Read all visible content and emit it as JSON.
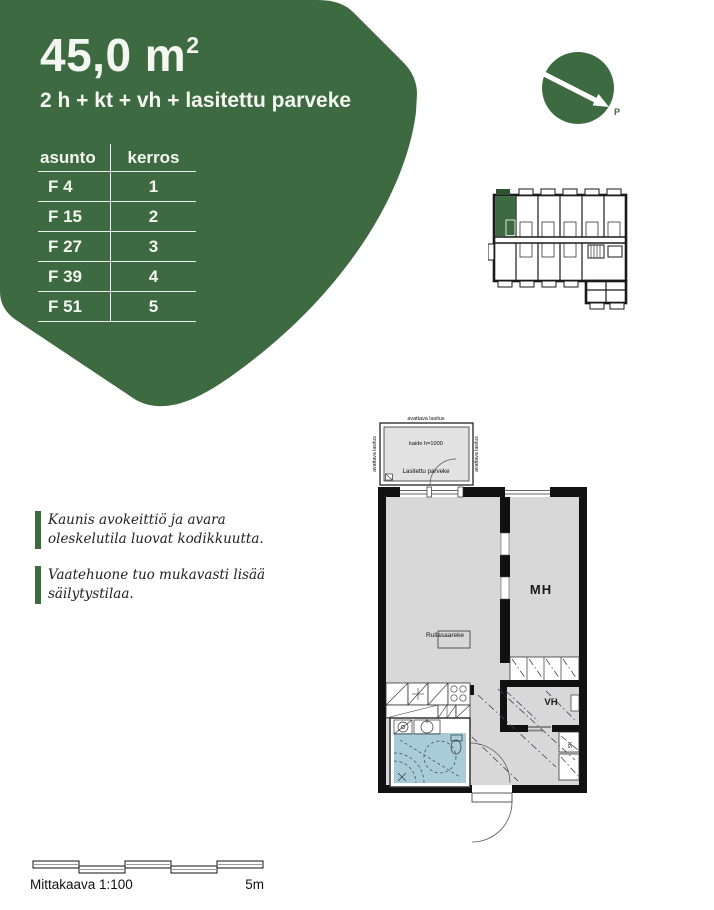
{
  "header": {
    "area_value": "45,0 m",
    "area_exponent": "2",
    "layout_description": "2 h + kt + vh + lasitettu parveke"
  },
  "apartment_table": {
    "col1": "asunto",
    "col2": "kerros",
    "rows": [
      {
        "asunto": "F 4",
        "kerros": "1"
      },
      {
        "asunto": "F 15",
        "kerros": "2"
      },
      {
        "asunto": "F 27",
        "kerros": "3"
      },
      {
        "asunto": "F 39",
        "kerros": "4"
      },
      {
        "asunto": "F 51",
        "kerros": "5"
      }
    ]
  },
  "compass": {
    "north_label": "P"
  },
  "notes": [
    {
      "text": "Kaunis avokeittiö ja avara oleskelutila luovat kodikkuutta."
    },
    {
      "text": "Vaatehuone tuo mukavasti lisää säilytystilaa."
    }
  ],
  "floorplan": {
    "balcony_glazing_top": "avattava lasitus",
    "balcony_glazing_left": "avattava lasitus",
    "balcony_glazing_right": "avattava lasitus",
    "railing_label": "kaide h=1000",
    "balcony_name": "Lasitettu parveke",
    "island_label": "Rullasaareke",
    "bedroom_label": "MH",
    "walkin_closet_label": "VH",
    "cleaning_closet_label": "SK"
  },
  "scale": {
    "caption": "Mittakaava  1:100",
    "max_label": "5m"
  },
  "colors": {
    "brand_green": "#3d6a41",
    "bathroom_blue": "#a8cdd9",
    "floor_gray": "#d8d8d8"
  }
}
